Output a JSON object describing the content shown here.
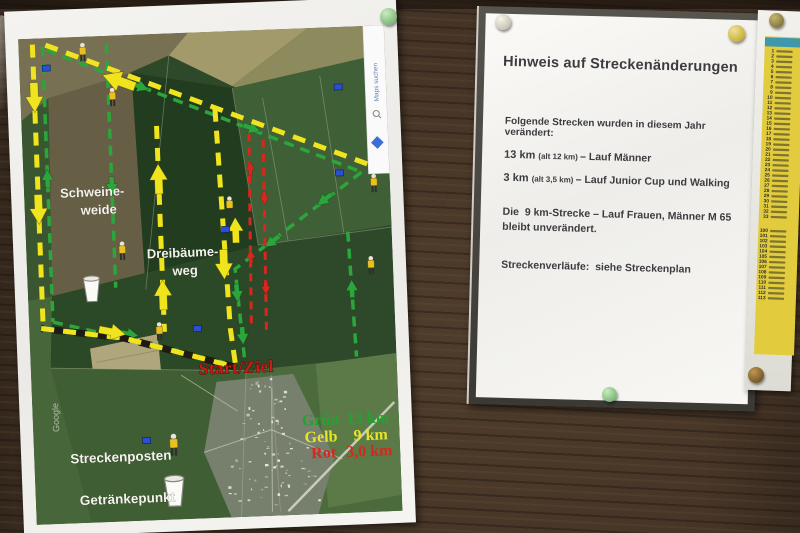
{
  "board": {
    "wood_color": "#453426"
  },
  "map_poster": {
    "labels": {
      "area1_line1": "Schweine-",
      "area1_line2": "weide",
      "area2_line1": "Dreibäume-",
      "area2_line2": "weg",
      "start_finish": "Start/Ziel",
      "marshal_post": "Streckenposten",
      "drink_point": "Getränkepunkt",
      "watermark": "Google",
      "maps_sidebar": "Maps suchen"
    },
    "legend": [
      {
        "label": "Grün",
        "value": "13 km",
        "color": "#1fa52f"
      },
      {
        "label": "Gelb",
        "value": "9 km",
        "color": "#e9e427"
      },
      {
        "label": "Rot",
        "value": "3,0 km",
        "color": "#d5281e"
      }
    ],
    "route_colors": {
      "yellow": "#f0e41f",
      "green": "#2ca53c",
      "red": "#d8271c"
    },
    "start_color": "#ce1a13"
  },
  "notice": {
    "title": "Hinweis auf Streckenänderungen",
    "intro": "Folgende Strecken wurden in diesem Jahr verändert:",
    "changes": [
      {
        "distance": "13 km ",
        "old": "(alt 12 km) ",
        "event": "– Lauf Männer"
      },
      {
        "distance": "3 km ",
        "old": "(alt 3,5 km) ",
        "event": "– Lauf Junior Cup und Walking"
      }
    ],
    "unchanged_line1": "Die  9 km-Strecke – Lauf Frauen, Männer M 65",
    "unchanged_line2": "bleibt unverändert.",
    "footer": "Streckenverläufe:  siehe Streckenplan"
  },
  "start_list": {
    "block1": [
      1,
      2,
      3,
      4,
      5,
      6,
      7,
      8,
      9,
      10,
      11,
      12,
      13,
      14,
      15,
      16,
      17,
      18,
      19,
      20,
      21,
      22,
      23,
      24,
      25,
      26,
      27,
      28,
      29,
      30,
      31,
      32,
      33
    ],
    "block2": [
      100,
      101,
      102,
      103,
      104,
      105,
      106,
      107,
      108,
      109,
      110,
      111,
      112,
      113
    ]
  },
  "pins": {
    "map_top": {
      "light": "#cdeac0",
      "dark": "#5ea65c"
    },
    "notice_left": {
      "light": "#f7f4e9",
      "dark": "#b5b1a0"
    },
    "notice_right": {
      "light": "#efe29a",
      "dark": "#b89f12"
    },
    "list_top": {
      "light": "#c4b56e",
      "dark": "#6f5f2c"
    },
    "notice_bottom": {
      "light": "#c9ecbe",
      "dark": "#5ca65a"
    },
    "list_bottom": {
      "light": "#c0974f",
      "dark": "#58411b"
    }
  }
}
